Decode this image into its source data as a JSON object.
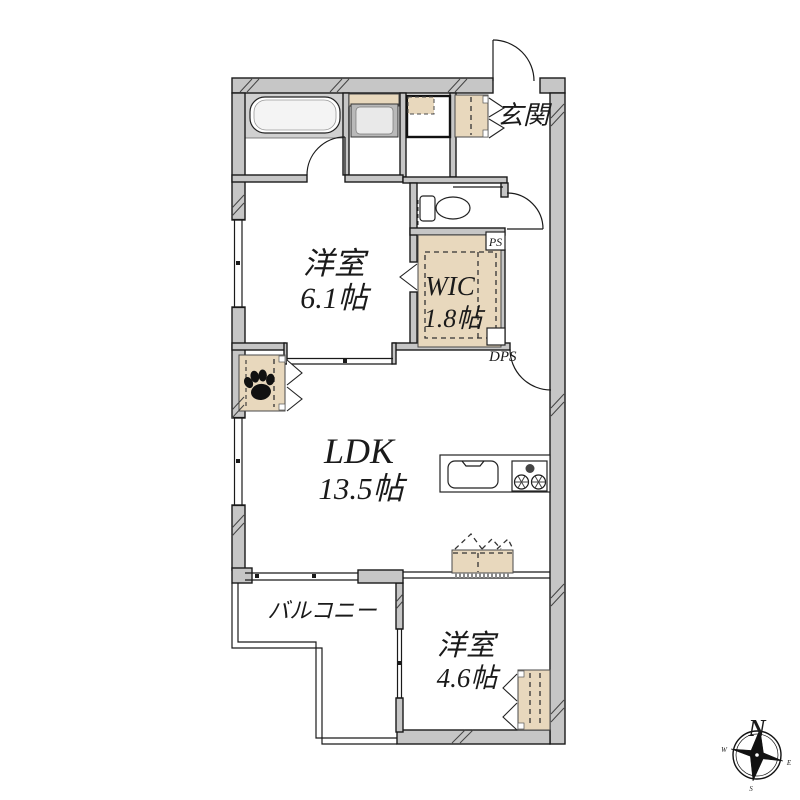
{
  "floorplan": {
    "rooms": {
      "genkan": {
        "label": "玄関"
      },
      "bedroom1": {
        "label": "洋室",
        "size": "6.1帖"
      },
      "wic": {
        "label": "WIC",
        "size": "1.8帖"
      },
      "ldk": {
        "label": "LDK",
        "size": "13.5帖"
      },
      "bedroom2": {
        "label": "洋室",
        "size": "4.6帖"
      },
      "balcony": {
        "label": "バルコニー"
      }
    },
    "shafts": {
      "ps": "PS",
      "dps": "DPS"
    },
    "compass": {
      "n": "N",
      "w": "W",
      "e": "E",
      "s": "S"
    },
    "colors": {
      "background": "#ffffff",
      "wall": "#c6c6c6",
      "line": "#1a1a1a",
      "closet": "#e8d8bd",
      "bath_floor": "#d0d0d0"
    }
  }
}
